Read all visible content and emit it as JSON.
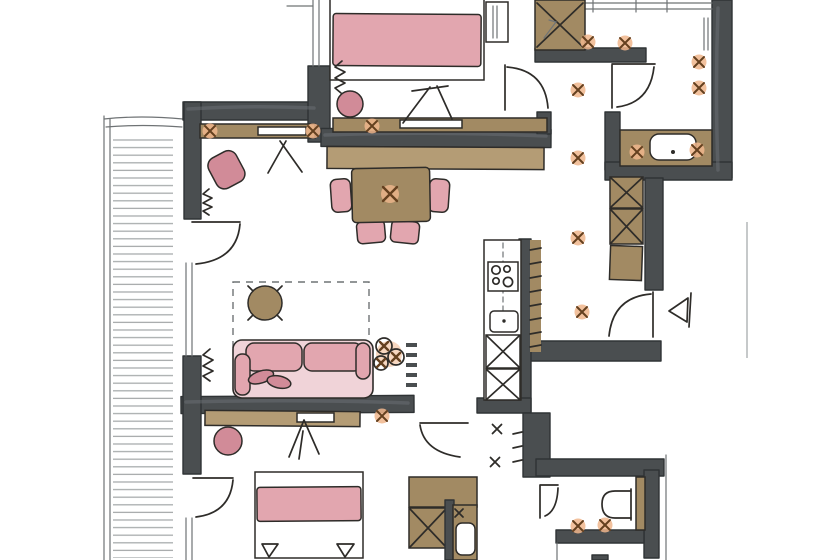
{
  "canvas": {
    "width": 820,
    "height": 560,
    "background": "#ffffff"
  },
  "palette": {
    "paper": "#ffffff",
    "ink": "#2e2c29",
    "ink_soft": "#6f7375",
    "pencil": "#a8acad",
    "wall": "#4a4e50",
    "wall_stroke": "#2f3335",
    "wood": "#a28a63",
    "wood_light": "#b49c75",
    "pink": "#e2a6af",
    "pink_deep": "#d18b98",
    "pink_pale": "#f0d3d8",
    "peach": "#f0b68c",
    "x_brown": "#64401f"
  },
  "plan": {
    "type": "apartment-floor-plan-sketch",
    "rooms": [
      {
        "name": "terrace",
        "features": [
          "decking-hatch",
          "terrace-edge",
          "terrace-door-top",
          "terrace-door-bottom"
        ]
      },
      {
        "name": "study",
        "furniture": [
          "desk-counter",
          "laptop",
          "desk-chair",
          "tv-easel",
          "radiator"
        ]
      },
      {
        "name": "bedroom-top",
        "furniture": [
          "double-bed",
          "pink-blanket",
          "round-stool",
          "nightstand",
          "wardrobe",
          "sideboard",
          "laptop",
          "tv-easel",
          "radiator",
          "room-door"
        ]
      },
      {
        "name": "living-dining",
        "furniture": [
          "long-sideboard",
          "dining-table",
          "dining-chair-left",
          "dining-chair-right",
          "dining-chair-bottom-1",
          "dining-chair-bottom-2",
          "rug",
          "coffee-table",
          "sofa",
          "sofa-pillows",
          "plant",
          "wall-shelf",
          "media-sideboard",
          "tv-easel",
          "ottoman",
          "radiator"
        ]
      },
      {
        "name": "kitchen",
        "furniture": [
          "counter",
          "cooktop-4-burners",
          "sink",
          "tall-cabinet-1",
          "tall-cabinet-2",
          "tiled-strip"
        ]
      },
      {
        "name": "corridor",
        "features": [
          "ceiling-lights",
          "closet-unit-1",
          "closet-unit-2",
          "closet-unit-3",
          "entry-door",
          "entrance-arrow"
        ]
      },
      {
        "name": "bathroom",
        "furniture": [
          "vanity-counter",
          "basin",
          "faucet",
          "ceiling-lights",
          "door"
        ]
      },
      {
        "name": "bedroom-bottom",
        "furniture": [
          "double-bed",
          "pink-blanket",
          "pillow-1",
          "pillow-2",
          "terrace-door"
        ]
      },
      {
        "name": "utility-closet",
        "furniture": [
          "cabinet-top",
          "x-cabinet",
          "washing-machine"
        ]
      },
      {
        "name": "wc",
        "furniture": [
          "wall-hung-toilet",
          "door",
          "ceiling-lights"
        ]
      },
      {
        "name": "hallway-bottom",
        "features": [
          "door-to-living",
          "ceiling-marks"
        ]
      }
    ],
    "symbol_counts": {
      "ceiling_light_x": 15,
      "dark_x_marks": 3,
      "door_arcs": 7,
      "radiator_squiggles": 3,
      "tv_easels": 3
    }
  }
}
